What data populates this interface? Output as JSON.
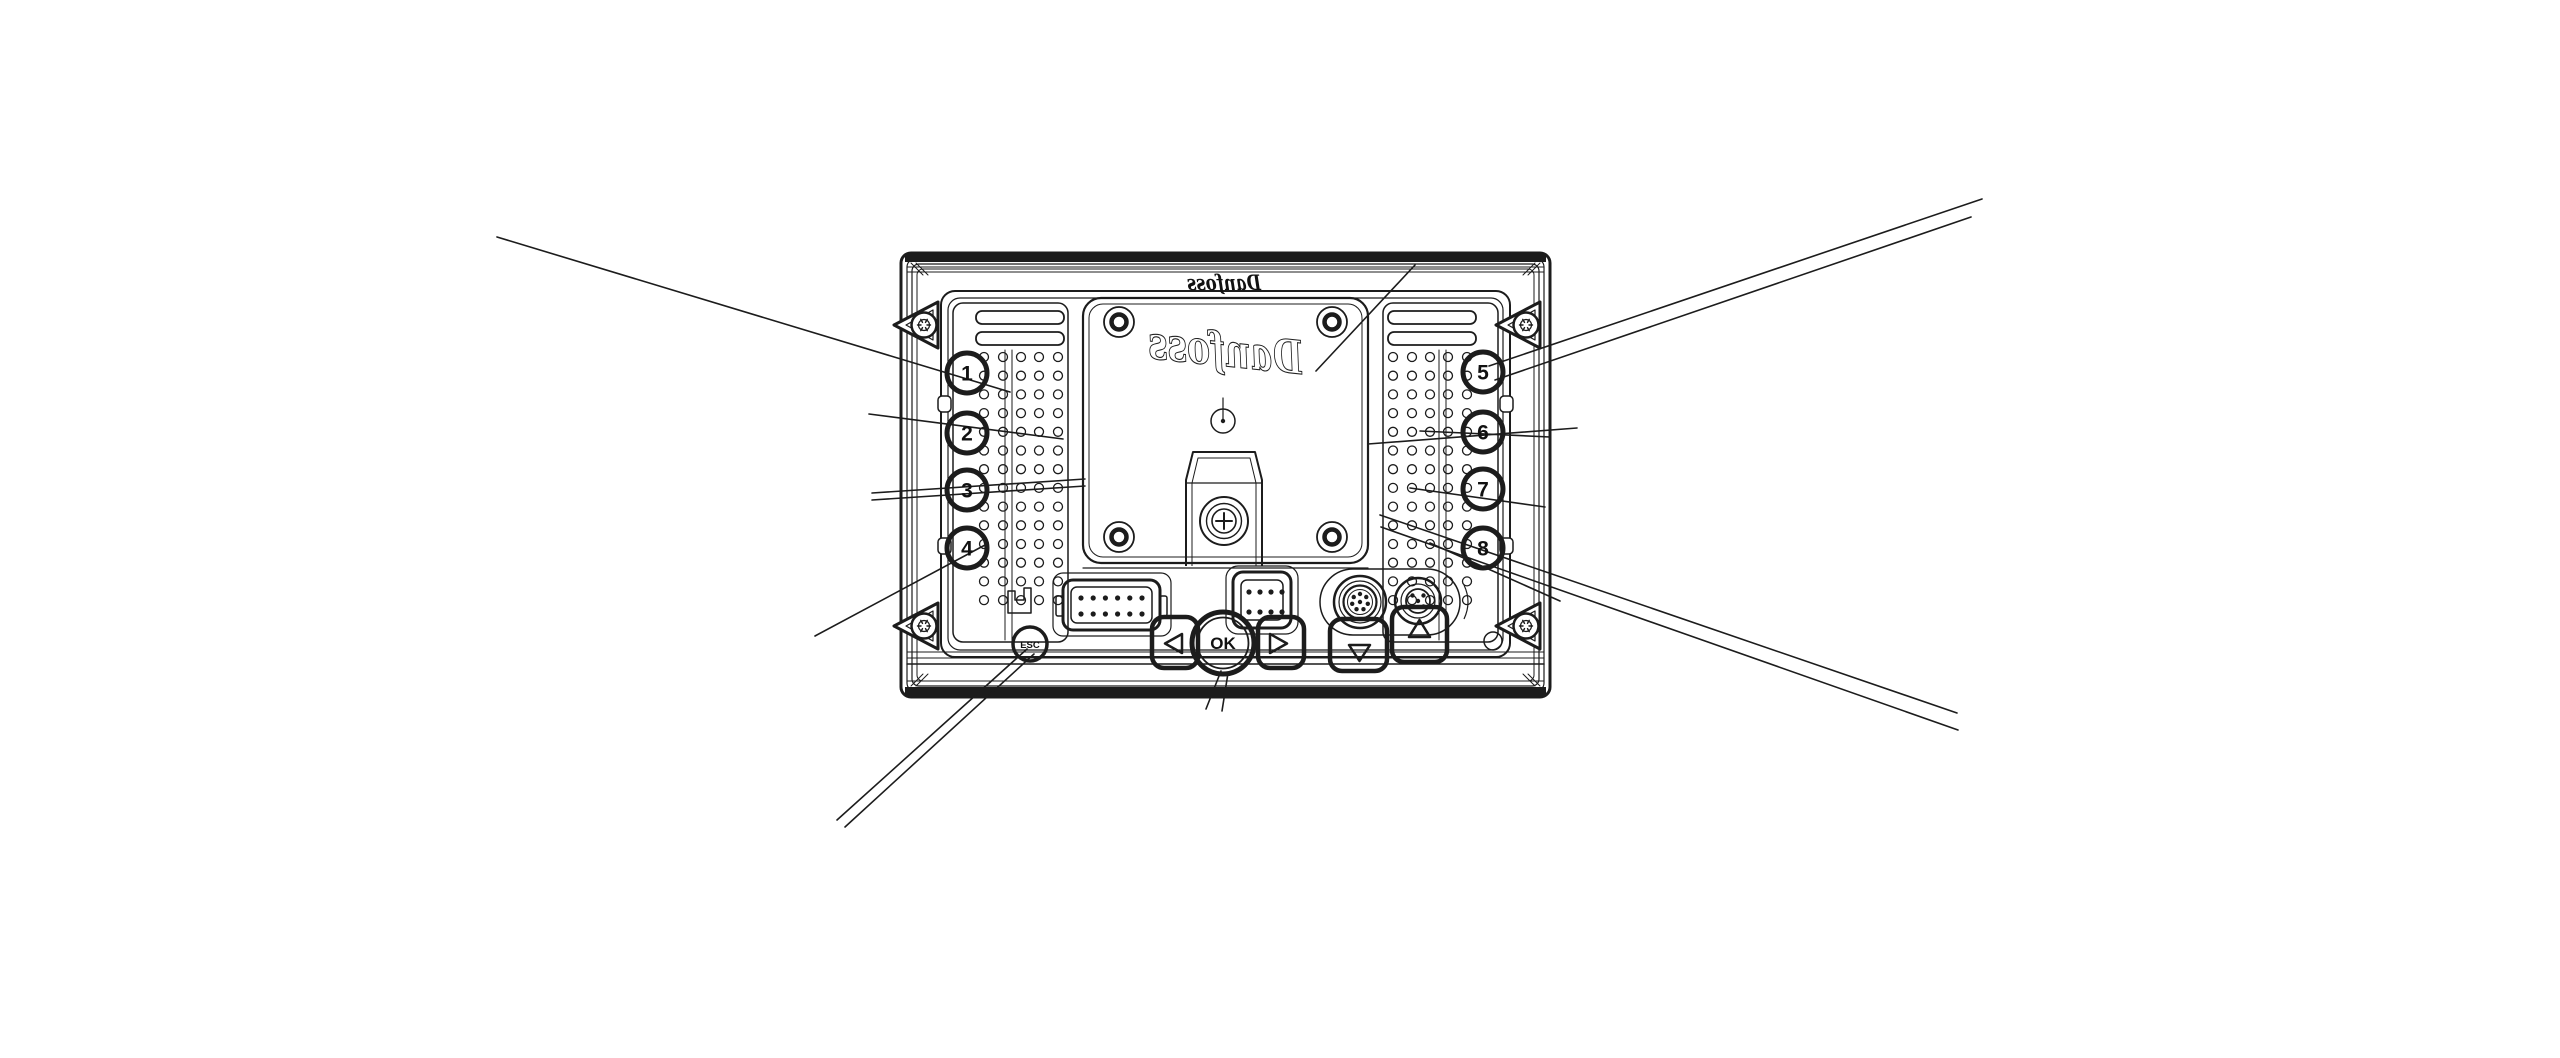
{
  "diagram": {
    "title": "Danfoss display unit - rear view technical drawing",
    "type": "line-drawing",
    "background": "#ffffff",
    "line_color": "#1c1c1c",
    "logo_top": "Danfoss",
    "logo_panel": "Danfoss",
    "callouts_left": [
      "1",
      "2",
      "3",
      "4"
    ],
    "callouts_right": [
      "5",
      "6",
      "7",
      "8"
    ],
    "buttons": {
      "esc_label": "ESC",
      "ok_label": "OK",
      "left_icon": "left-triangle",
      "right_icon": "right-triangle",
      "up_icon": "up-triangle",
      "down_icon": "down-triangle"
    }
  }
}
